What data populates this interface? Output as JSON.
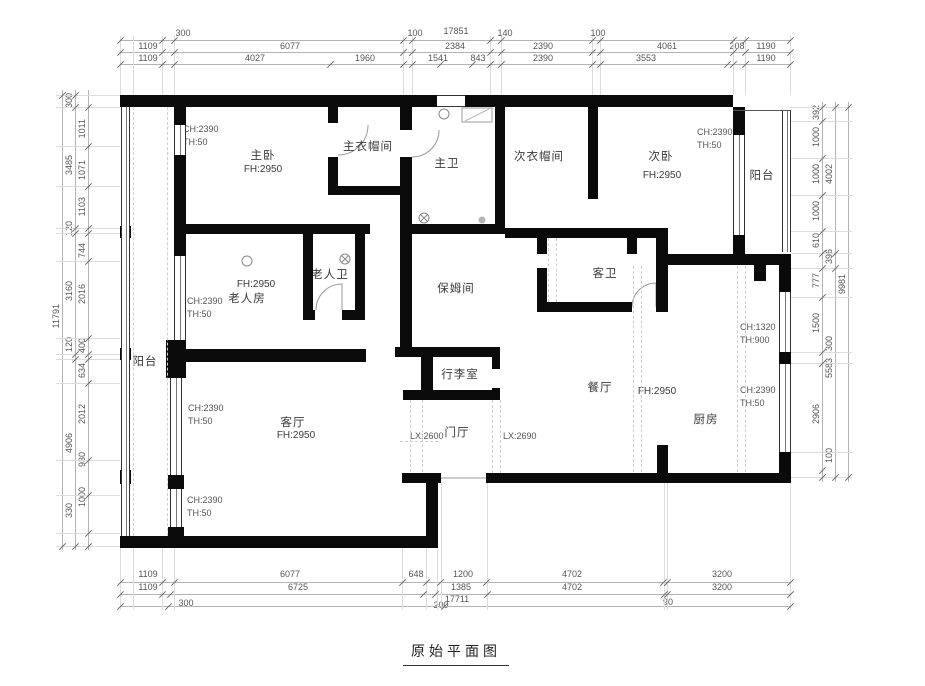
{
  "title": "原始平面图",
  "colors": {
    "wall": "#0a0a0a",
    "dim_line": "#b3b3b3",
    "dim_text": "#555555"
  },
  "rooms": {
    "master_bedroom": {
      "label": "主卧",
      "fh": "FH:2950"
    },
    "master_cloak": {
      "label": "主衣帽间"
    },
    "master_bath": {
      "label": "主卫"
    },
    "second_cloak": {
      "label": "次衣帽间"
    },
    "second_bedroom": {
      "label": "次卧",
      "fh": "FH:2950"
    },
    "balcony_right": {
      "label": "阳台"
    },
    "elder_room": {
      "label": "老人房",
      "fh": "FH:2950"
    },
    "elder_bath": {
      "label": "老人卫"
    },
    "nanny_room": {
      "label": "保姆间"
    },
    "guest_bath": {
      "label": "客卫"
    },
    "balcony_left": {
      "label": "阳台"
    },
    "living_room": {
      "label": "客厅",
      "fh": "FH:2950"
    },
    "luggage_room": {
      "label": "行李室"
    },
    "foyer": {
      "label": "门厅",
      "lx_left": "LX:2600",
      "lx_right": "LX:2690"
    },
    "dining_room": {
      "label": "餐厅",
      "fh": "FH:2950"
    },
    "kitchen": {
      "label": "厨房"
    }
  },
  "notes": {
    "n1": {
      "l1": "CH:2390",
      "l2": "TH:50"
    },
    "n2": {
      "l1": "CH:2390",
      "l2": "TH:50"
    },
    "n3": {
      "l1": "CH:2390",
      "l2": "TH:50"
    },
    "n4": {
      "l1": "CH:1320",
      "l2": "TH:900"
    },
    "n5": {
      "l1": "CH:2390",
      "l2": "TH:50"
    },
    "n6": {
      "l1": "CH:2390",
      "l2": "TH:50"
    },
    "n7": {
      "l1": "CH:2390",
      "l2": "TH:50"
    }
  },
  "dims": {
    "top0": [
      "300",
      "17851",
      "100",
      "140",
      "100",
      "208"
    ],
    "top1": [
      "1109",
      "6077",
      "2384",
      "2390",
      "4061",
      "1190"
    ],
    "top2": [
      "1109",
      "4027",
      "1960",
      "1541",
      "843",
      "2390",
      "3553",
      "1190"
    ],
    "left_outer": [
      "11791"
    ],
    "left_mid": [
      "300",
      "3485",
      "120",
      "3160",
      "120",
      "4906",
      "330"
    ],
    "left_inner": [
      "1011",
      "1071",
      "1103",
      "744",
      "2016",
      "400",
      "634",
      "2012",
      "930",
      "1000"
    ],
    "right_inner": [
      "392",
      "1000",
      "1000",
      "1000",
      "610",
      "777",
      "1500",
      "2906"
    ],
    "right_mid": [
      "4002",
      "396",
      "300",
      "5583",
      "100"
    ],
    "right_outer": [
      "9981"
    ],
    "bottom1": [
      "1109",
      "6077",
      "648",
      "1200",
      "4702",
      "3200"
    ],
    "bottom2": [
      "1109",
      "6725",
      "1385",
      "4702",
      "3200"
    ],
    "bottom3": [
      "300",
      "200",
      "17711",
      "90"
    ]
  }
}
